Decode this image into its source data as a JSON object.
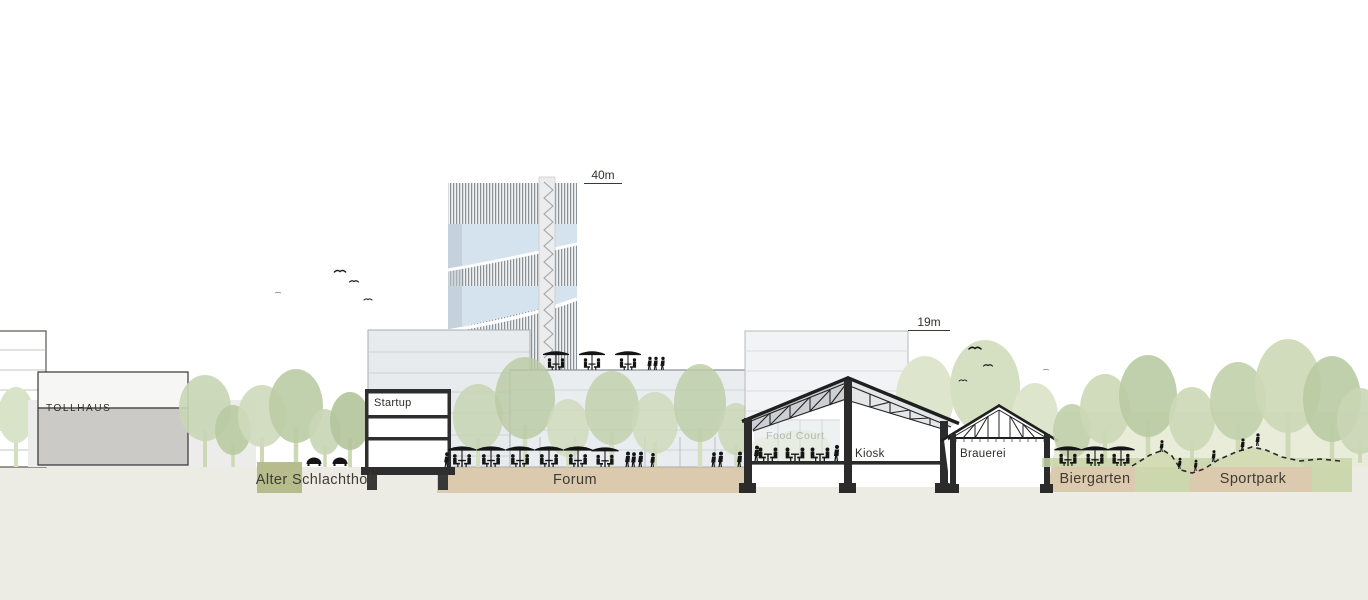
{
  "drawing": {
    "buildings": {
      "tollhaus": "TOLLHAUS",
      "startup": "Startup",
      "food_court": "Food Court",
      "kiosk": "Kiosk",
      "brauerei": "Brauerei"
    },
    "measurements": {
      "tower": "40m",
      "hall": "19m"
    },
    "zones": [
      {
        "label": "Alter Schlachthof"
      },
      {
        "label": "Forum"
      },
      {
        "label": "Biergarten"
      },
      {
        "label": "Sportpark"
      }
    ],
    "colors": {
      "ground_base": "#edece4",
      "ground_tan": "#dccaae",
      "grass_green": "#ccd7ad",
      "tree_light": "#ccd8b6",
      "tree_dark": "#b7c9a2",
      "glass_blue": "#d5e3ee",
      "section_dark": "#2b2b2b",
      "label_text": "#3b3a34"
    }
  }
}
